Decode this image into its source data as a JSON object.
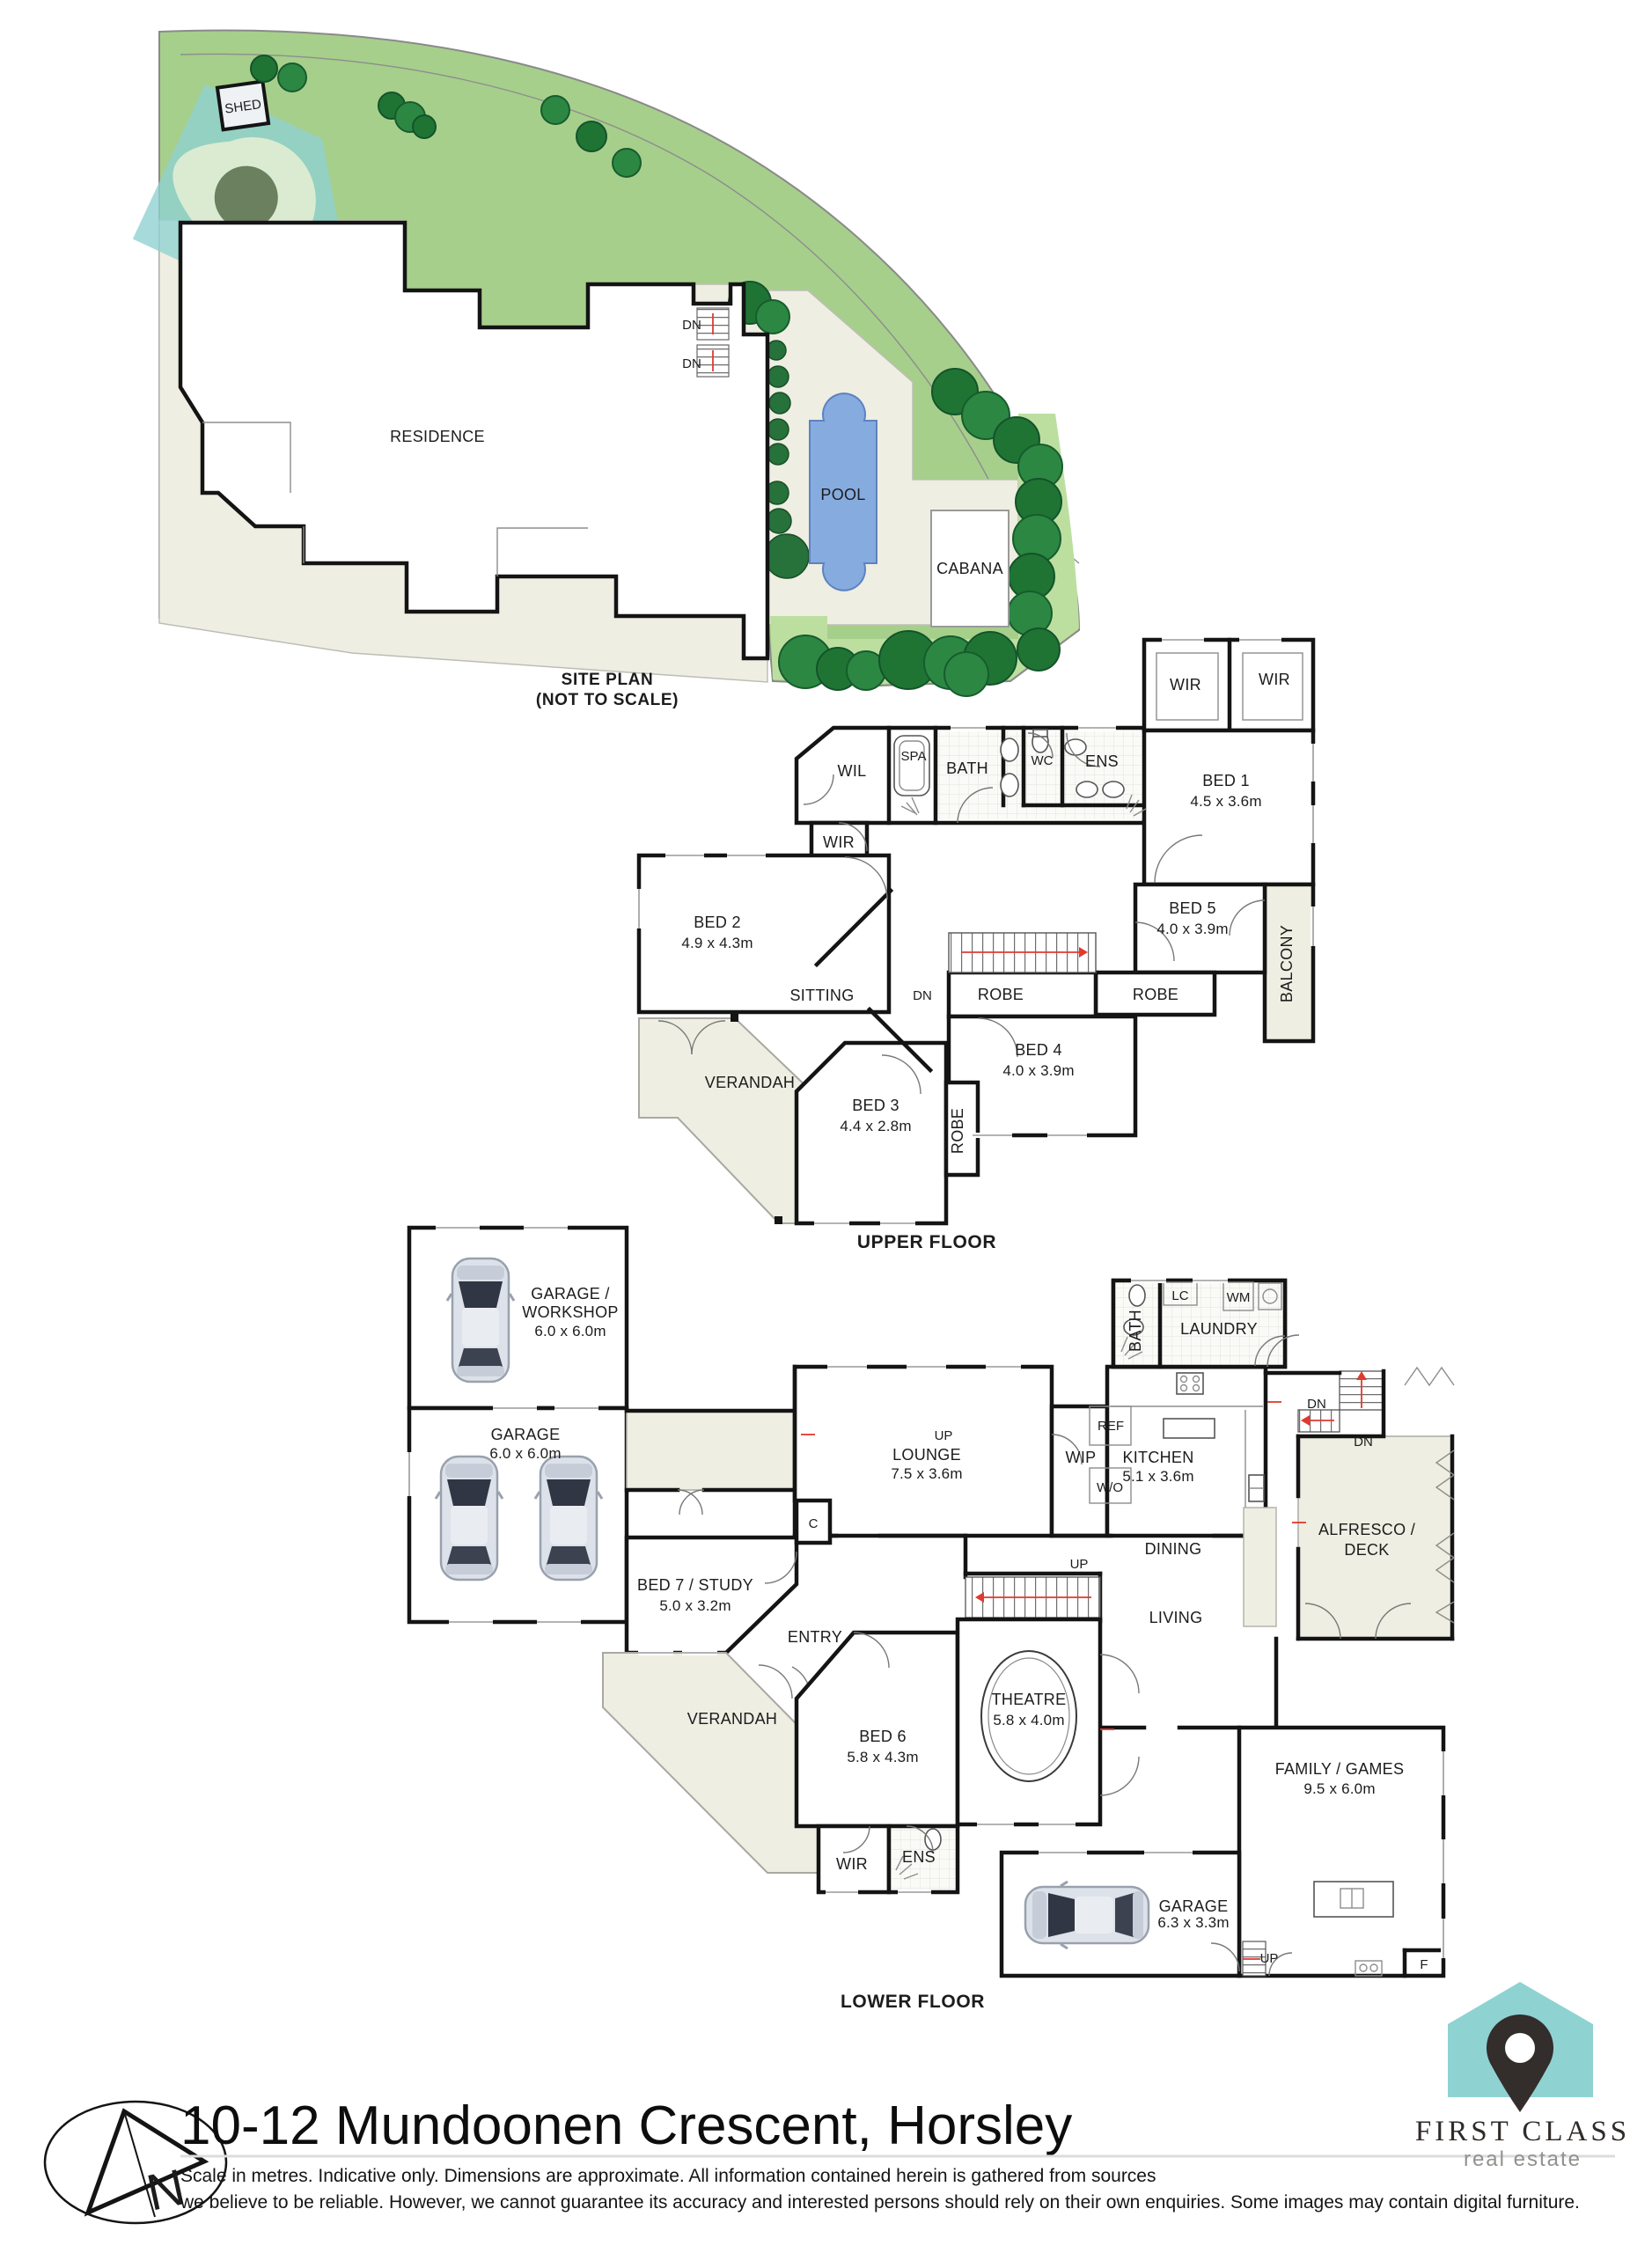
{
  "site": {
    "shed": "SHED",
    "residence": "RESIDENCE",
    "pool": "POOL",
    "cabana": "CABANA",
    "dn_top": "DN",
    "dn_bottom": "DN",
    "caption_1": "SITE PLAN",
    "caption_2": "(NOT TO SCALE)"
  },
  "upper": {
    "caption": "UPPER FLOOR",
    "wir_left": "WIR",
    "wir_right": "WIR",
    "bed1_label": "BED 1",
    "bed1_dims": "4.5 x 3.6m",
    "bed5_label": "BED 5",
    "bed5_dims": "4.0 x 3.9m",
    "balcony": "BALCONY",
    "robe_bed5": "ROBE",
    "robe_bed4": "ROBE",
    "robe_bed3": "ROBE",
    "bed4_label": "BED 4",
    "bed4_dims": "4.0 x 3.9m",
    "ens": "ENS",
    "wc": "WC",
    "bath": "BATH",
    "spa": "SPA",
    "wil": "WIL",
    "wir_small": "WIR",
    "bed2_label": "BED 2",
    "bed2_dims": "4.9 x 4.3m",
    "sitting": "SITTING",
    "dn": "DN",
    "verandah": "VERANDAH",
    "bed3_label": "BED 3",
    "bed3_dims": "4.4 x 2.8m"
  },
  "lower": {
    "caption": "LOWER FLOOR",
    "workshop_1": "GARAGE /",
    "workshop_2": "WORKSHOP",
    "workshop_dims": "6.0 x 6.0m",
    "garage_label": "GARAGE",
    "garage_dims": "6.0 x 6.0m",
    "bed7_label": "BED 7 / STUDY",
    "bed7_dims": "5.0 x 3.2m",
    "entry": "ENTRY",
    "verandah": "VERANDAH",
    "closet": "C",
    "bed6_label": "BED 6",
    "bed6_dims": "5.8 x 4.3m",
    "wir": "WIR",
    "ens": "ENS",
    "theatre_label": "THEATRE",
    "theatre_dims": "5.8 x 4.0m",
    "lounge_up": "UP",
    "lounge_label": "LOUNGE",
    "lounge_dims": "7.5 x 3.6m",
    "wip": "WIP",
    "ref": "REF",
    "wo": "W/O",
    "kitchen_label": "KITCHEN",
    "kitchen_dims": "5.1 x 3.6m",
    "bath": "BATH",
    "lc": "LC",
    "wm": "WM",
    "laundry": "LAUNDRY",
    "dn_a": "DN",
    "dn_b": "DN",
    "dining": "DINING",
    "living": "LIVING",
    "alfresco_1": "ALFRESCO /",
    "alfresco_2": "DECK",
    "family_label": "FAMILY / GAMES",
    "family_dims": "9.5 x 6.0m",
    "garage2_label": "GARAGE",
    "garage2_dims": "6.3 x 3.3m",
    "up_stairs": "UP",
    "up_garage": "UP",
    "fridge": "F"
  },
  "footer": {
    "title": "10-12 Mundoonen Crescent, Horsley",
    "disclaimer_1": "Scale in metres. Indicative only. Dimensions are approximate. All information contained herein is gathered from sources",
    "disclaimer_2": "we believe to be reliable. However, we cannot guarantee its accuracy and interested persons should rely on their own enquiries. Some images may contain digital furniture.",
    "north": "N"
  },
  "logo": {
    "line1": "FIRST CLASS",
    "line2": "real estate"
  },
  "colors": {
    "grass": "#a6cf8b",
    "grass_light": "#bcdfa0",
    "tree": "#1f7434",
    "tree_dark": "#14532a",
    "pool": "#86abdf",
    "pool_border": "#5d82c2",
    "cream": "#efeee2",
    "teal": "#8fd2d2",
    "teal_circle": "#5b6b52",
    "pin_dark": "#332d2b",
    "wall": "#141414",
    "red": "#e03a2f"
  }
}
